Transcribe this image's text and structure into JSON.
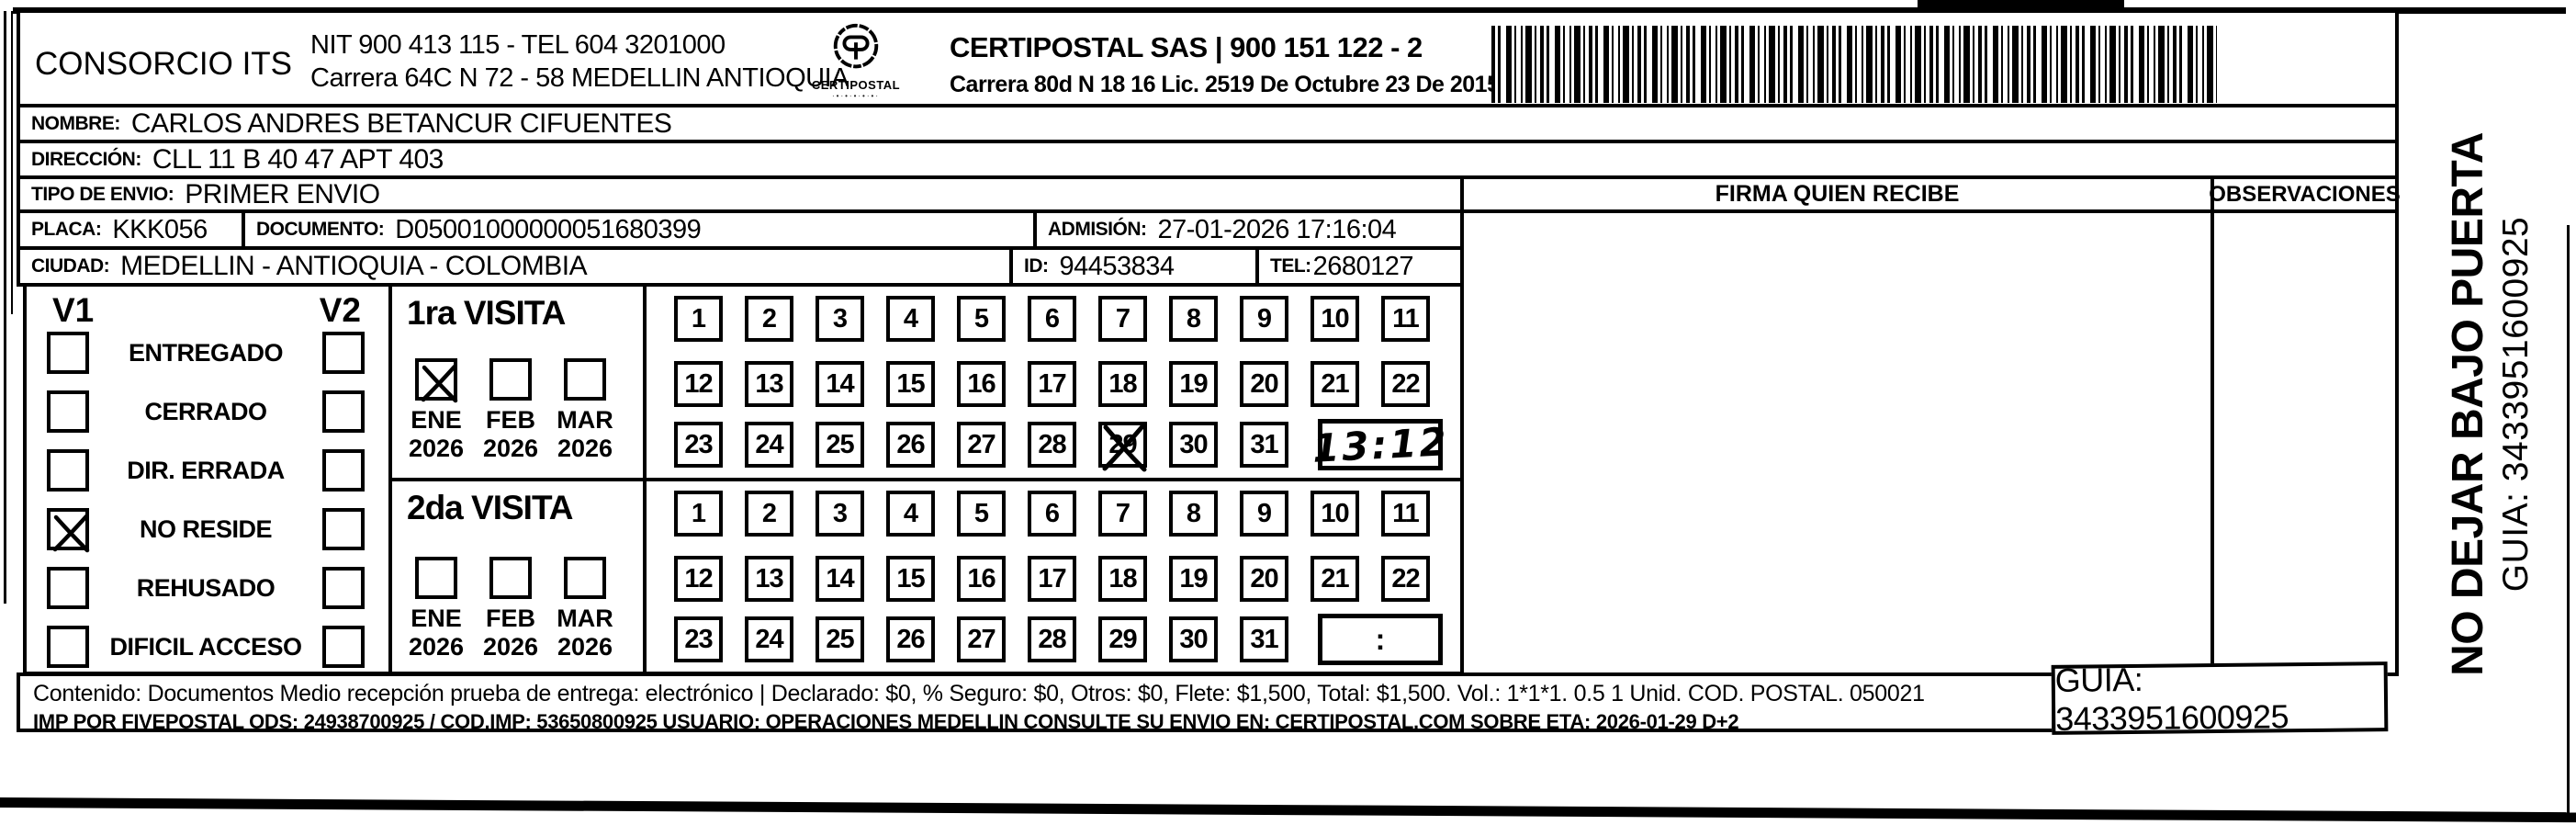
{
  "form": {
    "company": {
      "name": "CONSORCIO ITS",
      "nit_tel": "NIT 900 413 115 - TEL 604 3201000",
      "address": "Carrera 64C N 72 - 58 MEDELLIN ANTIOQUIA"
    },
    "operator": {
      "logo_text": "CERTIPOSTAL",
      "logo_sub": "·•·•·•·•·•·",
      "name_nit": "CERTIPOSTAL SAS | 900 151 122 - 2",
      "address_lic": "Carrera 80d N 18 16  Lic. 2519 De Octubre 23 De 2015"
    },
    "fields": {
      "nombre": {
        "label": "NOMBRE:",
        "value": "CARLOS ANDRES BETANCUR CIFUENTES"
      },
      "direccion": {
        "label": "DIRECCIÓN:",
        "value": "CLL 11 B 40 47 APT 403"
      },
      "tipo_envio": {
        "label": "TIPO DE ENVIO:",
        "value": "PRIMER ENVIO"
      },
      "placa": {
        "label": "PLACA:",
        "value": "KKK056"
      },
      "documento": {
        "label": "DOCUMENTO:",
        "value": "D05001000000051680399"
      },
      "admision": {
        "label": "ADMISIÓN:",
        "value": "27-01-2026 17:16:04"
      },
      "ciudad": {
        "label": "CIUDAD:",
        "value": "MEDELLIN - ANTIOQUIA - COLOMBIA"
      },
      "id": {
        "label": "ID:",
        "value": "94453834"
      },
      "tel": {
        "label": "TEL:",
        "value": "2680127"
      }
    },
    "columns": {
      "firma": "FIRMA QUIEN RECIBE",
      "observaciones": "OBSERVACIONES"
    },
    "status": {
      "col1": "V1",
      "col2": "V2",
      "options": [
        {
          "label": "ENTREGADO",
          "v1": false,
          "v2": false
        },
        {
          "label": "CERRADO",
          "v1": false,
          "v2": false
        },
        {
          "label": "DIR. ERRADA",
          "v1": false,
          "v2": false
        },
        {
          "label": "NO RESIDE",
          "v1": true,
          "v2": false
        },
        {
          "label": "REHUSADO",
          "v1": false,
          "v2": false
        },
        {
          "label": "DIFICIL ACCESO",
          "v1": false,
          "v2": false
        }
      ]
    },
    "visits": [
      {
        "title": "1ra VISITA",
        "months": [
          {
            "label": "ENE",
            "year": "2026",
            "checked": true
          },
          {
            "label": "FEB",
            "year": "2026",
            "checked": false
          },
          {
            "label": "MAR",
            "year": "2026",
            "checked": false
          }
        ],
        "day_rows": [
          [
            1,
            2,
            3,
            4,
            5,
            6,
            7,
            8,
            9,
            10,
            11
          ],
          [
            12,
            13,
            14,
            15,
            16,
            17,
            18,
            19,
            20,
            21,
            22
          ],
          [
            23,
            24,
            25,
            26,
            27,
            28,
            29,
            30,
            31
          ]
        ],
        "crossed_days": [
          29
        ],
        "time": "13:12"
      },
      {
        "title": "2da VISITA",
        "months": [
          {
            "label": "ENE",
            "year": "2026",
            "checked": false
          },
          {
            "label": "FEB",
            "year": "2026",
            "checked": false
          },
          {
            "label": "MAR",
            "year": "2026",
            "checked": false
          }
        ],
        "day_rows": [
          [
            1,
            2,
            3,
            4,
            5,
            6,
            7,
            8,
            9,
            10,
            11
          ],
          [
            12,
            13,
            14,
            15,
            16,
            17,
            18,
            19,
            20,
            21,
            22
          ],
          [
            23,
            24,
            25,
            26,
            27,
            28,
            29,
            30,
            31
          ]
        ],
        "crossed_days": [],
        "time": ":"
      }
    ],
    "footer": {
      "line1": "Contenido: Documentos Medio recepción prueba de entrega: electrónico | Declarado: $0, % Seguro: $0, Otros: $0, Flete: $1,500, Total: $1,500. Vol.: 1*1*1. 0.5 1 Unid. COD. POSTAL. 050021",
      "line2": "IMP POR FIVEPOSTAL ODS: 24938700925 / COD.IMP: 53650800925 USUARIO: OPERACIONES MEDELLIN CONSULTE SU ENVIO EN: CERTIPOSTAL.COM SOBRE ETA: 2026-01-29 D+2",
      "guia": "GUIA: 3433951600925"
    },
    "side_note": {
      "line1": "NO DEJAR BAJO PUERTA",
      "line2": "GUIA: 3433951600925"
    }
  }
}
